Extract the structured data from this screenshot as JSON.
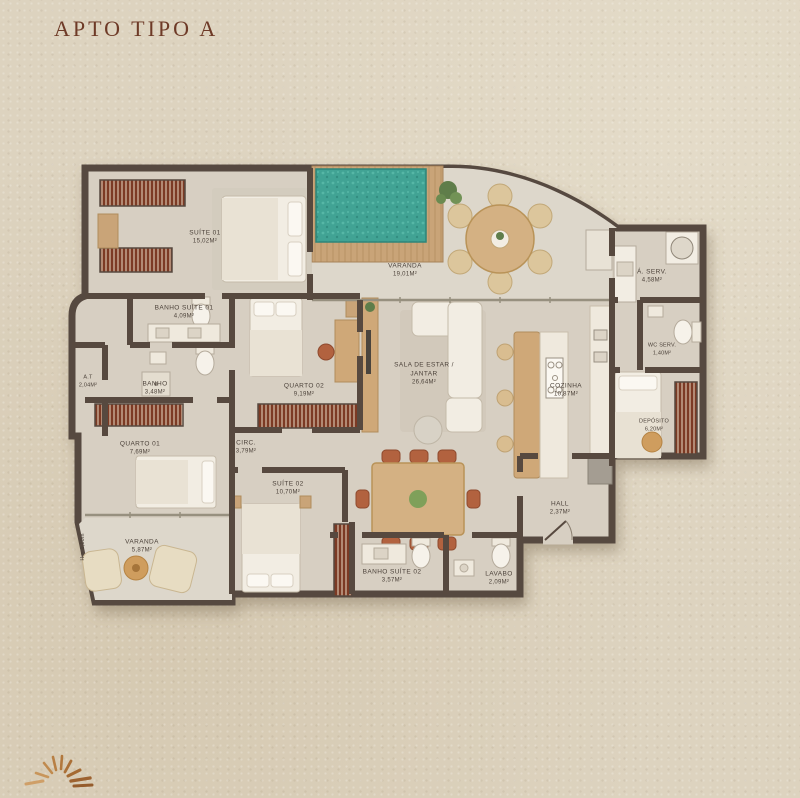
{
  "page": {
    "title": "APTO TIPO A"
  },
  "plan": {
    "rooms": [
      {
        "name": "SUÍTE 01",
        "area": "15,02M²"
      },
      {
        "name": "VARANDA",
        "area": "19,01M²"
      },
      {
        "name": "Á. SERV.",
        "area": "4,58M²"
      },
      {
        "name": "BANHO SUÍTE 01",
        "area": "4,09M²"
      },
      {
        "name": "A.T",
        "area": "2,04M²"
      },
      {
        "name": "BANHO",
        "area": "3,48M²"
      },
      {
        "name": "QUARTO 02",
        "area": "9,19M²"
      },
      {
        "name": "SALA DE ESTAR / JANTAR",
        "area": "26,64M²"
      },
      {
        "name": "COZINHA",
        "area": "10,87M²"
      },
      {
        "name": "WC SERV.",
        "area": "1,40M²"
      },
      {
        "name": "DEPÓSITO",
        "area": "6,20M²"
      },
      {
        "name": "QUARTO 01",
        "area": "7,69M²"
      },
      {
        "name": "CIRC.",
        "area": "3,79M²"
      },
      {
        "name": "SUÍTE 02",
        "area": "10,70M²"
      },
      {
        "name": "VARANDA",
        "area": "5,87M²"
      },
      {
        "name": "BANHO SUÍTE 02",
        "area": "3,57M²"
      },
      {
        "name": "LAVABO",
        "area": "2,09M²"
      },
      {
        "name": "HALL",
        "area": "2,37M²"
      }
    ],
    "annotation": {
      "ceiling_height": "H = 1,10m"
    },
    "colors": {
      "background": "#ddd3bf",
      "title": "#6e3a27",
      "wall": "#57493f",
      "floor": "#d7cfc2",
      "balcony_floor": "#ddd7cb",
      "pool": "#41a394",
      "deck": "#c9a478",
      "closet": "#7c3a24",
      "chair_accent": "#b2623f"
    },
    "icons": {
      "logo": "sunburst-icon"
    }
  }
}
